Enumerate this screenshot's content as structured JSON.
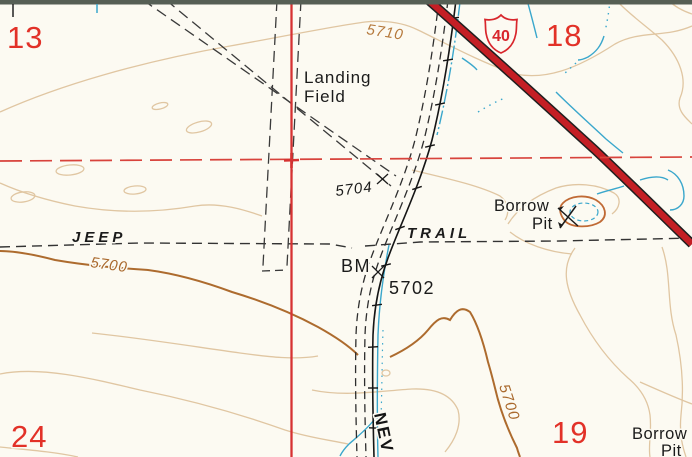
{
  "page": {
    "background": "#fcfaf2",
    "neatline_band": "#565f55"
  },
  "colors": {
    "red_numbers": "#e23128",
    "section_line": "#d63232",
    "land_line_dashed": "#d8433c",
    "highway_red": "#c41f25",
    "highway_casing": "#1f1f1f",
    "contour_light": "#e0c6a2",
    "contour_index": "#ad6b2e",
    "water_blue": "#3aa7cc",
    "label_black": "#1b1b1b",
    "contour_label_brown": "#b5793c"
  },
  "sections": {
    "nw": "13",
    "ne": "18",
    "sw": "24",
    "se": "19"
  },
  "labels": {
    "landing_field": {
      "line1": "Landing",
      "line2": "Field"
    },
    "jeep": "JEEP",
    "trail": "TRAIL",
    "spot_elevation": "5704",
    "benchmark": {
      "bm": "BM",
      "elevation": "5702"
    },
    "borrow_pit_upper": {
      "line1": "Borrow",
      "line2": "Pit"
    },
    "borrow_pit_lower": {
      "line1": "Borrow",
      "line2": "Pit"
    },
    "road_name": "NEV"
  },
  "contour_labels": {
    "upper": "5710",
    "left": "5700",
    "lower_right": "5700"
  },
  "route_shield": {
    "number": "40"
  },
  "symbols": {
    "shield": "us-route-shield",
    "benchmark": "benchmark-x",
    "spot": "spot-elevation-x",
    "pit": "pick-and-shovel-icon",
    "corner": "section-corner-cross",
    "powerline": "power-line-ticks"
  }
}
